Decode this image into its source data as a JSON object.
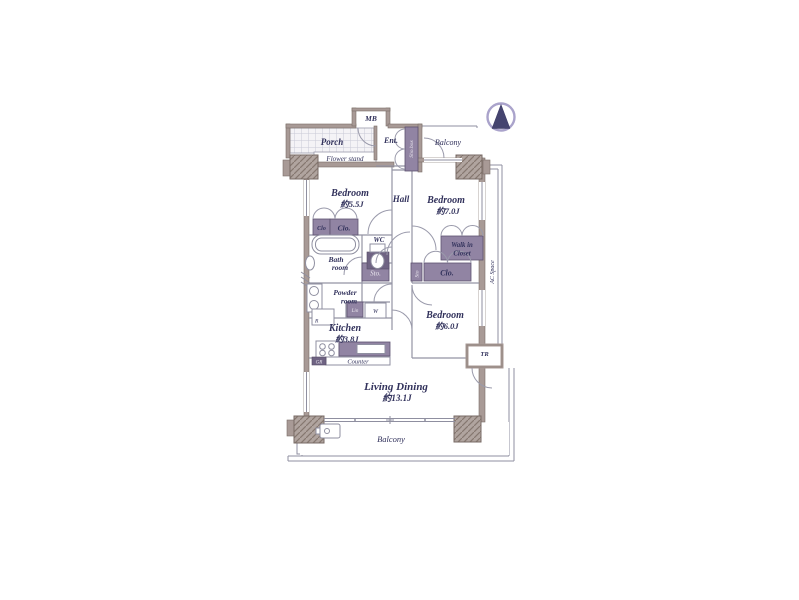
{
  "colors": {
    "wall": "#a89a96",
    "closet_fill": "#9184a3",
    "closet_dark": "#6f6383",
    "label_text": "#32325c",
    "thin_line": "#8f8fa0",
    "compass": "#45446f",
    "background": "#ffffff"
  },
  "labels": {
    "mb": "MB",
    "porch": "Porch",
    "flower_stand": "Flower stand",
    "ent": "Ent.",
    "shoebox": "Sho.box",
    "balcony_top": "Balcony",
    "bedroom1_name": "Bedroom",
    "bedroom1_size": "約5.5J",
    "hall": "Hall",
    "bedroom2_name": "Bedroom",
    "bedroom2_size": "約7.0J",
    "clo_small": "Clo",
    "clo_1": "Clo.",
    "wc": "WC",
    "bath_1": "Bath",
    "bath_2": "room",
    "sto_main": "Sto.",
    "walkin_1": "Walk in",
    "walkin_2": "Closet",
    "sto_side": "Sto",
    "clo_2": "Clo.",
    "bedroom3_name": "Bedroom",
    "bedroom3_size": "約6.0J",
    "powder_1": "Powder",
    "powder_2": "room",
    "lin": "Lin",
    "washer": "W",
    "fridge": "R",
    "kitchen_name": "Kitchen",
    "kitchen_size": "約3.8J",
    "counter": "Counter",
    "gr": "GR",
    "living_name": "Living Dining",
    "living_size": "約13.1J",
    "balcony_bottom": "Balcony",
    "ac_space": "AC Space",
    "tr": "TR"
  }
}
